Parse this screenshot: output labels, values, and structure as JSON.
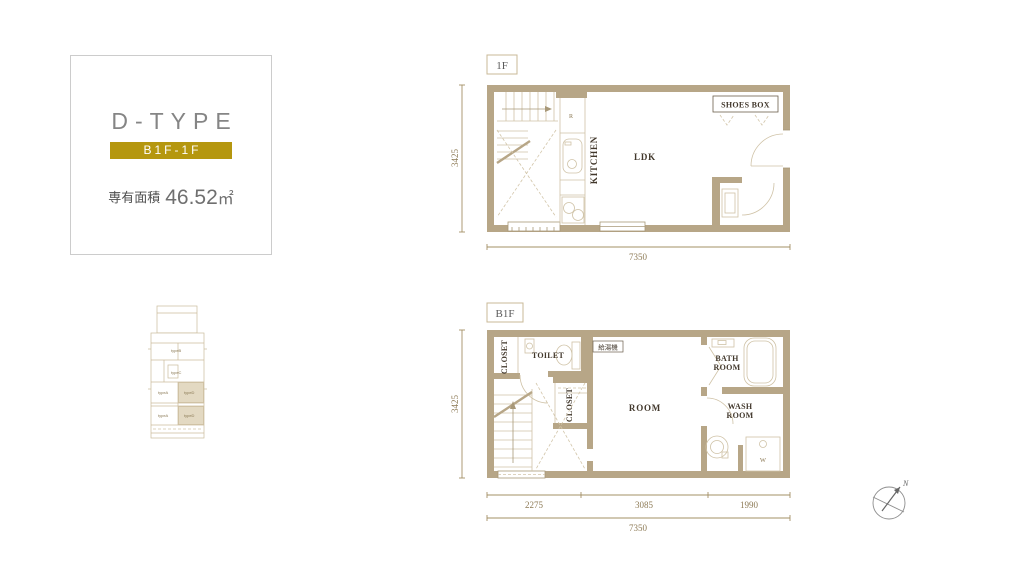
{
  "info_card": {
    "type_name": "D-TYPE",
    "floor_badge": "B1F-1F",
    "area_label": "専有面積",
    "area_value": "46.52",
    "area_unit": "㎡"
  },
  "key_plan": {
    "unit_labels": [
      "typeB",
      "typeC",
      "typeA",
      "typeD",
      "typeA",
      "typeD"
    ]
  },
  "floor_1f": {
    "label": "1F",
    "room_ldk": "LDK",
    "room_kitchen": "KITCHEN",
    "shoes_box": "SHOES BOX",
    "fridge_mark": "R",
    "dim_height": "3425",
    "dim_width": "7350"
  },
  "floor_b1f": {
    "label": "B1F",
    "room_main": "ROOM",
    "closet_upper": "CLOSET",
    "closet_inner": "CLOSET",
    "toilet": "TOILET",
    "bath_line1": "BATH",
    "bath_line2": "ROOM",
    "wash_line1": "WASH",
    "wash_line2": "ROOM",
    "water_heater": "給湯機",
    "washer_mark": "W",
    "dim_height": "3425",
    "dim_seg1": "2275",
    "dim_seg2": "3085",
    "dim_seg3": "1990",
    "dim_total": "7350"
  },
  "compass": {
    "north": "N"
  },
  "colors": {
    "wall": "#b7a687",
    "dimension_line": "#a39065",
    "accent_gold": "#b5970f",
    "highlight": "#e3d9c2"
  }
}
